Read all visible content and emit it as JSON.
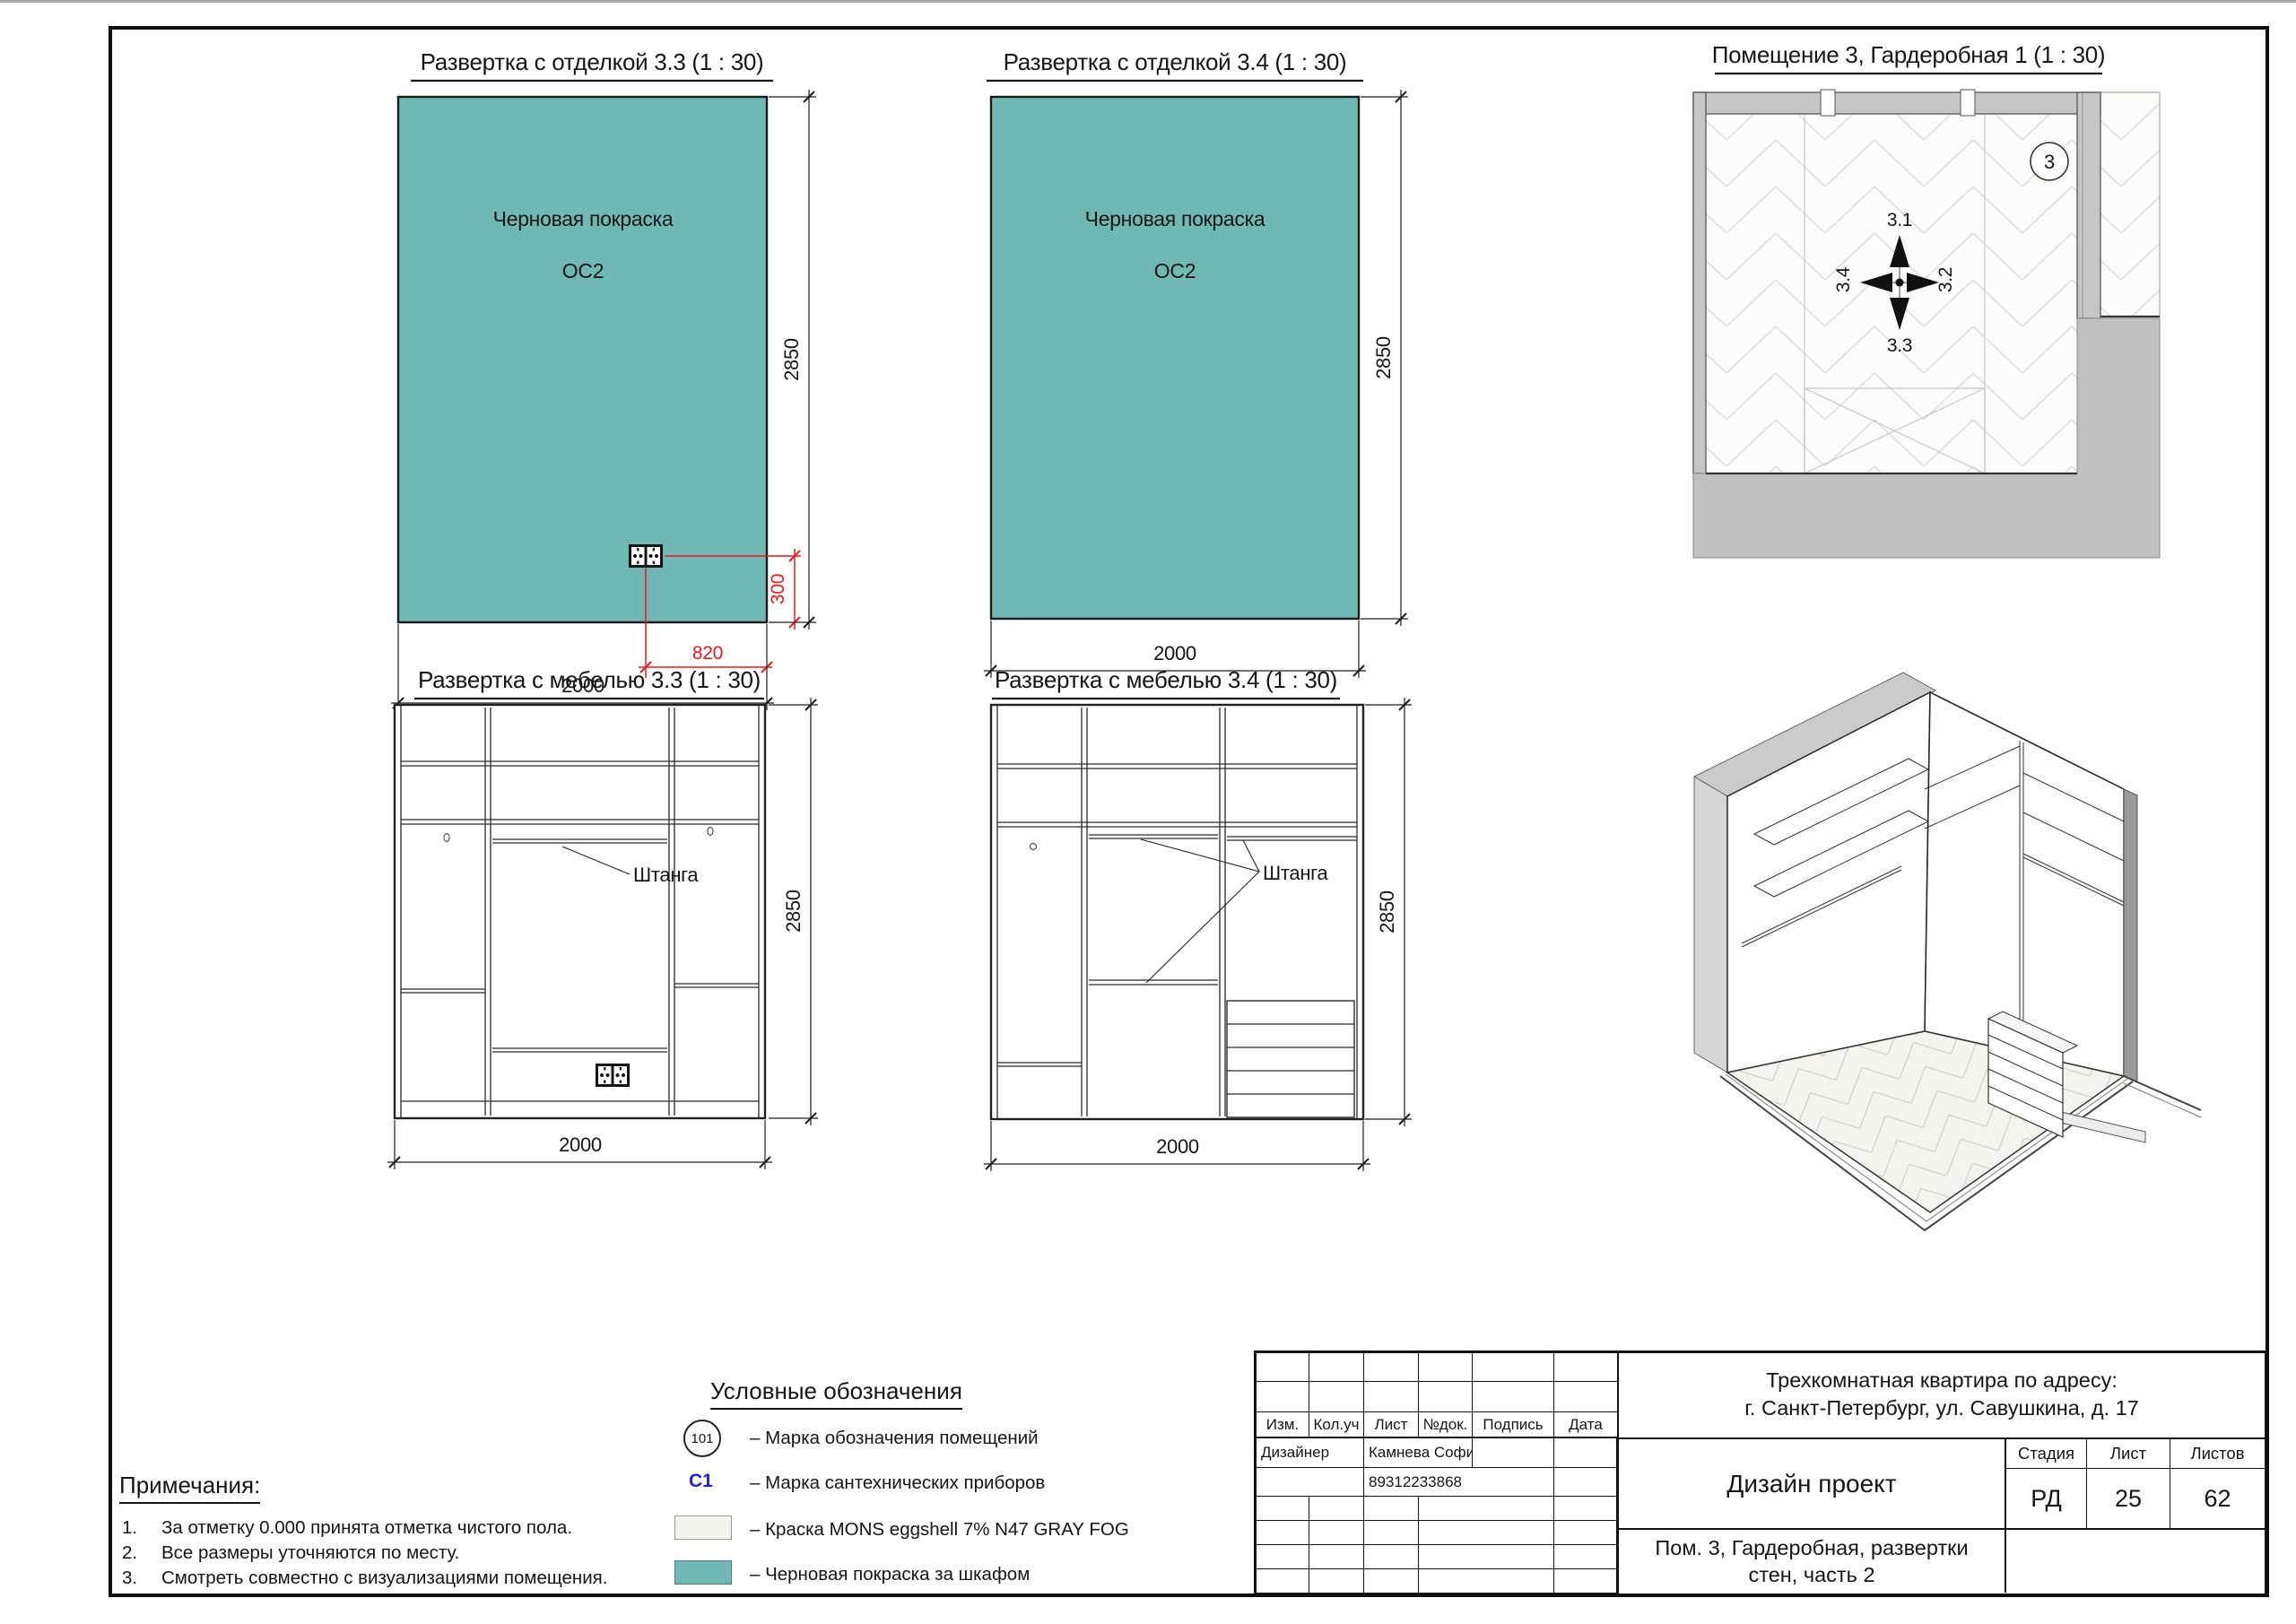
{
  "sheet": {
    "panels": {
      "finish33": {
        "title": "Развертка с отделкой 3.3 (1 : 30)",
        "paint_label": "Черновая покраска",
        "paint_code": "ОС2",
        "dim_height": "2850",
        "dim_width": "2000",
        "dim_outlet_height": "300",
        "dim_outlet_offset": "820"
      },
      "finish34": {
        "title": "Развертка с отделкой 3.4 (1 : 30)",
        "paint_label": "Черновая покраска",
        "paint_code": "ОС2",
        "dim_height": "2850",
        "dim_width": "2000"
      },
      "furniture33": {
        "title": "Развертка с мебелью 3.3 (1 : 30)",
        "rod_label": "Штанга",
        "dim_height": "2850",
        "dim_width": "2000"
      },
      "furniture34": {
        "title": "Развертка с мебелью 3.4 (1 : 30)",
        "rod_label": "Штанга",
        "dim_height": "2850",
        "dim_width": "2000"
      },
      "plan": {
        "title": "Помещение 3, Гардеробная 1 (1 : 30)",
        "room_number": "3",
        "dir_up": "3.1",
        "dir_right": "3.2",
        "dir_down": "3.3",
        "dir_left": "3.4"
      }
    },
    "legend": {
      "title": "Условные обозначения",
      "items": [
        {
          "symbol": "101",
          "label": "– Марка обозначения помещений"
        },
        {
          "symbol": "С1",
          "label": "– Марка сантехнических приборов"
        },
        {
          "symbol": "paint-swatch",
          "label": "– Краска MONS eggshell 7% N47 GRAY FOG"
        },
        {
          "symbol": "teal-swatch",
          "label": "– Черновая покраска за шкафом"
        }
      ]
    },
    "notes": {
      "title": "Примечания:",
      "items": [
        {
          "num": "1.",
          "text": "За отметку 0.000 принята отметка чистого пола."
        },
        {
          "num": "2.",
          "text": "Все размеры уточняются по месту."
        },
        {
          "num": "3.",
          "text": "Смотреть совместно с визуализациями помещения."
        }
      ]
    },
    "titleblock": {
      "cols": [
        "Изм.",
        "Кол.уч",
        "Лист",
        "№док.",
        "Подпись",
        "Дата"
      ],
      "designer_label": "Дизайнер",
      "designer_name": "Камнева София",
      "designer_phone": "89312233868",
      "address_line1": "Трехкомнатная квартира по адресу:",
      "address_line2": "г. Санкт-Петербург, ул. Савушкина, д. 17",
      "project_type": "Дизайн проект",
      "stage_label": "Стадия",
      "sheet_label": "Лист",
      "sheets_label": "Листов",
      "stage": "РД",
      "sheet_number": "25",
      "sheets_total": "62",
      "doc_title_line1": "Пом. 3, Гардеробная, развертки",
      "doc_title_line2": "стен, часть 2"
    },
    "colors": {
      "teal": "#6FB8B4",
      "paint_swatch": "#F3F2EE",
      "dim_red": "#F01818",
      "mark_blue": "#1F1FD6",
      "wall_gray": "#C6C6C6",
      "mass_gray": "#C0C0C0"
    }
  }
}
